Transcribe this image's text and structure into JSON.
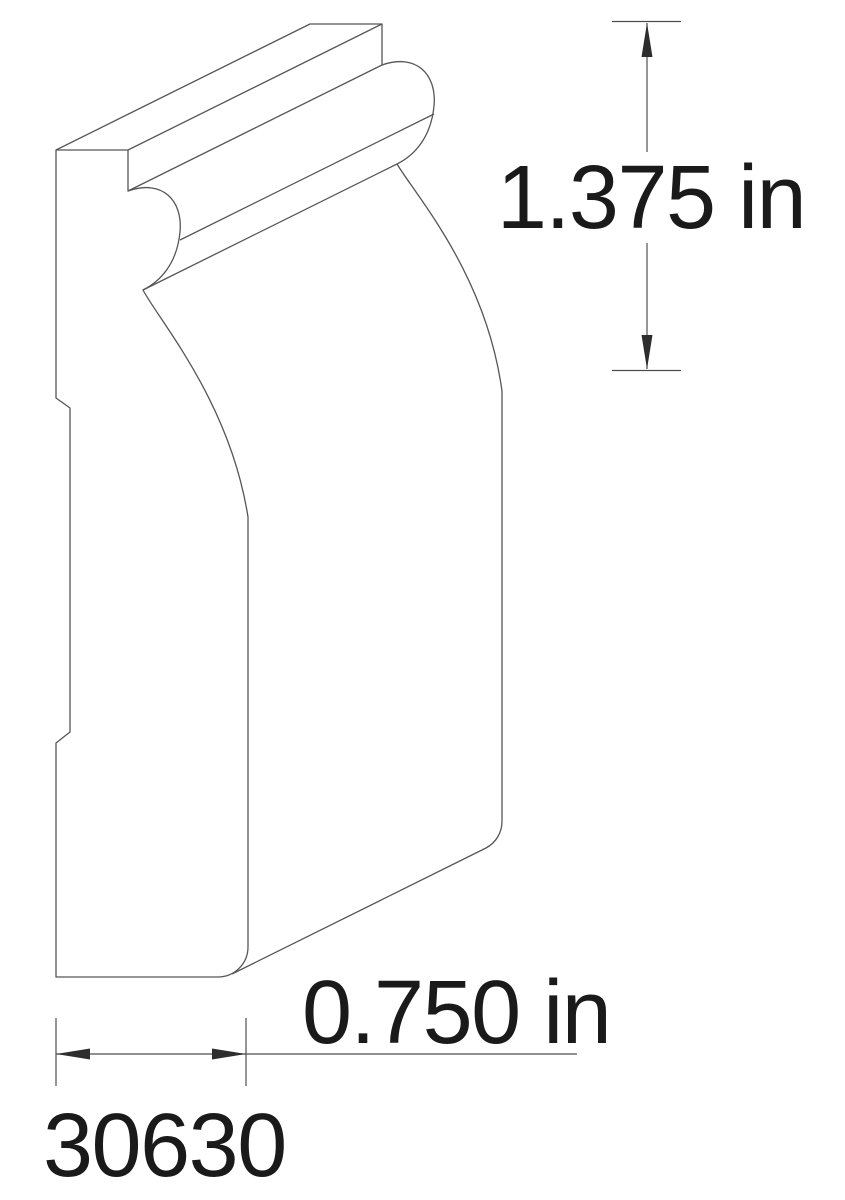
{
  "drawing": {
    "type": "molding-profile-technical-drawing",
    "part_number": "30630",
    "height_label": "1.375 in",
    "width_label": "0.750 in",
    "height_value": 1.375,
    "width_value": 0.75,
    "unit": "in"
  },
  "colors": {
    "background": "#ffffff",
    "line": "#565656",
    "hatch": "#565656",
    "text": "#1a1a1a"
  }
}
